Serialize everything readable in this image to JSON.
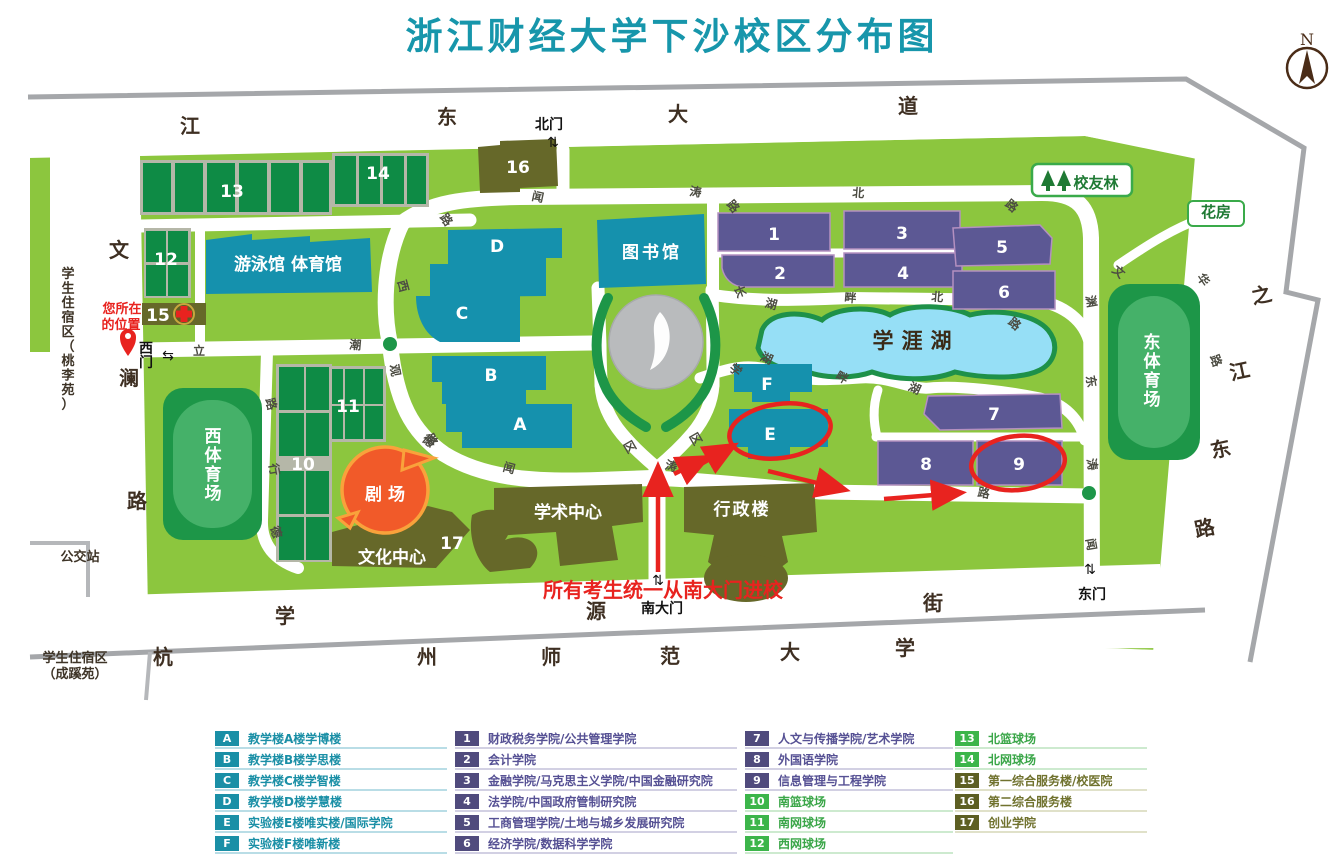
{
  "title": "浙江财经大学下沙校区分布图",
  "compass": {
    "label": "N"
  },
  "colors": {
    "title_teal": "#1796ab",
    "campus_green": "#8cc63e",
    "teal_building": "#1591ad",
    "purple_building": "#5c5894",
    "olive_building": "#666829",
    "court_green": "#0e8b45",
    "stadium_green": "#1d9648",
    "lake_blue": "#96dff6",
    "highlight_red": "#e8231f",
    "theater_orange": "#f15a29",
    "road_gray": "#a5a7aa"
  },
  "map": {
    "streets": {
      "north": "江东大道",
      "west": "文澜路",
      "south": "学源街",
      "east": "之江东路",
      "south_neighbor": "杭州师范大学"
    },
    "gates": {
      "north": "北门",
      "west": "西门",
      "south": "南大门",
      "east": "东门"
    },
    "annotations": {
      "you_are_here_line1": "您所在",
      "you_are_here_line2": "的位置",
      "entrance_note": "所有考生统一从南大门进校"
    },
    "labels": [
      {
        "t": "江",
        "x": 190,
        "y": 133,
        "cls": "st",
        "n": "street-char-jiangdong"
      },
      {
        "t": "东",
        "x": 447,
        "y": 124,
        "cls": "st",
        "n": "street-char-jiangdong"
      },
      {
        "t": "大",
        "x": 678,
        "y": 121,
        "cls": "st",
        "n": "street-char-jiangdong"
      },
      {
        "t": "道",
        "x": 908,
        "y": 113,
        "cls": "st",
        "n": "street-char-jiangdong"
      },
      {
        "t": "文",
        "x": 119,
        "y": 257,
        "cls": "st",
        "n": "street-char-wenlan"
      },
      {
        "t": "澜",
        "x": 129,
        "y": 385,
        "cls": "st",
        "n": "street-char-wenlan"
      },
      {
        "t": "路",
        "x": 137,
        "y": 508,
        "cls": "st",
        "n": "street-char-wenlan"
      },
      {
        "t": "学",
        "x": 285,
        "y": 623,
        "cls": "st",
        "n": "street-char-xueyuan"
      },
      {
        "t": "源",
        "x": 596,
        "y": 618,
        "cls": "st",
        "n": "street-char-xueyuan"
      },
      {
        "t": "街",
        "x": 933,
        "y": 610,
        "cls": "st",
        "n": "street-char-xueyuan"
      },
      {
        "t": "之",
        "x": 1263,
        "y": 302,
        "cls": "st",
        "r": -12,
        "n": "street-char-zhijiangdong"
      },
      {
        "t": "江",
        "x": 1241,
        "y": 378,
        "cls": "st",
        "r": -12,
        "n": "street-char-zhijiangdong"
      },
      {
        "t": "东",
        "x": 1222,
        "y": 456,
        "cls": "st",
        "r": -12,
        "n": "street-char-zhijiangdong"
      },
      {
        "t": "路",
        "x": 1206,
        "y": 535,
        "cls": "st",
        "r": -12,
        "n": "street-char-zhijiangdong"
      },
      {
        "t": "杭",
        "x": 163,
        "y": 664,
        "cls": "st",
        "n": "street-char-hangshida"
      },
      {
        "t": "州",
        "x": 427,
        "y": 664,
        "cls": "st",
        "n": "street-char-hangshida"
      },
      {
        "t": "师",
        "x": 551,
        "y": 664,
        "cls": "st",
        "n": "street-char-hangshida"
      },
      {
        "t": "范",
        "x": 670,
        "y": 663,
        "cls": "st",
        "n": "street-char-hangshida"
      },
      {
        "t": "大",
        "x": 790,
        "y": 659,
        "cls": "st",
        "n": "street-char-hangshida"
      },
      {
        "t": "学",
        "x": 905,
        "y": 655,
        "cls": "st",
        "n": "street-char-hangshida"
      },
      {
        "t": "闻",
        "x": 537,
        "y": 201,
        "cls": "rd",
        "r": 12
      },
      {
        "t": "涛",
        "x": 695,
        "y": 196,
        "cls": "rd",
        "r": 8
      },
      {
        "t": "北",
        "x": 858,
        "y": 197,
        "cls": "rd",
        "r": 5
      },
      {
        "t": "路",
        "x": 1009,
        "y": 209,
        "cls": "rd",
        "r": 40
      },
      {
        "t": "路",
        "x": 730,
        "y": 209,
        "cls": "rd",
        "r": 50
      },
      {
        "t": "路",
        "x": 443,
        "y": 222,
        "cls": "rd",
        "r": 55
      },
      {
        "t": "西",
        "x": 399,
        "y": 287,
        "cls": "rd",
        "r": 75
      },
      {
        "t": "潮",
        "x": 355,
        "y": 349,
        "cls": "rd",
        "r": 5
      },
      {
        "t": "立",
        "x": 199,
        "y": 355,
        "cls": "rd"
      },
      {
        "t": "观",
        "x": 391,
        "y": 371,
        "cls": "rd",
        "r": 80
      },
      {
        "t": "路",
        "x": 428,
        "y": 442,
        "cls": "rd",
        "r": 60
      },
      {
        "t": "路",
        "x": 267,
        "y": 405,
        "cls": "rd",
        "r": 75
      },
      {
        "t": "行",
        "x": 270,
        "y": 470,
        "cls": "rd",
        "r": 80
      },
      {
        "t": "德",
        "x": 272,
        "y": 533,
        "cls": "rd",
        "r": 75
      },
      {
        "t": "德",
        "x": 426,
        "y": 444,
        "cls": "rd",
        "r": 40
      },
      {
        "t": "闻",
        "x": 508,
        "y": 472,
        "cls": "rd",
        "r": 15
      },
      {
        "t": "涛",
        "x": 670,
        "y": 470,
        "cls": "rd",
        "r": 15
      },
      {
        "t": "长",
        "x": 736,
        "y": 293,
        "cls": "rd",
        "r": 70
      },
      {
        "t": "湖",
        "x": 770,
        "y": 308,
        "cls": "rd",
        "r": 15
      },
      {
        "t": "畔",
        "x": 850,
        "y": 302,
        "cls": "rd",
        "r": 5
      },
      {
        "t": "北",
        "x": 937,
        "y": 301,
        "cls": "rd",
        "r": 5
      },
      {
        "t": "路",
        "x": 1012,
        "y": 327,
        "cls": "rd",
        "r": 40
      },
      {
        "t": "学",
        "x": 733,
        "y": 373,
        "cls": "rd",
        "r": 40
      },
      {
        "t": "湖",
        "x": 765,
        "y": 362,
        "cls": "rd",
        "r": 25
      },
      {
        "t": "畔",
        "x": 840,
        "y": 381,
        "cls": "rd",
        "r": 30
      },
      {
        "t": "区",
        "x": 626,
        "y": 449,
        "cls": "rd",
        "r": 60
      },
      {
        "t": "区",
        "x": 692,
        "y": 441,
        "cls": "rd",
        "r": 60
      },
      {
        "t": "湖",
        "x": 913,
        "y": 392,
        "cls": "rd",
        "r": 25
      },
      {
        "t": "路",
        "x": 983,
        "y": 497,
        "cls": "rd",
        "r": 10
      },
      {
        "t": "文",
        "x": 1116,
        "y": 275,
        "cls": "rd",
        "r": 40
      },
      {
        "t": "渊",
        "x": 1087,
        "y": 302,
        "cls": "rd",
        "r": 80
      },
      {
        "t": "东",
        "x": 1087,
        "y": 382,
        "cls": "rd",
        "r": 80
      },
      {
        "t": "涛",
        "x": 1088,
        "y": 465,
        "cls": "rd",
        "r": 80
      },
      {
        "t": "闻",
        "x": 1087,
        "y": 545,
        "cls": "rd",
        "r": 80
      },
      {
        "t": "华",
        "x": 1200,
        "y": 282,
        "cls": "rd",
        "r": 55
      },
      {
        "t": "路",
        "x": 1212,
        "y": 362,
        "cls": "rd",
        "r": 70
      },
      {
        "t": "A",
        "x": 520,
        "y": 430,
        "cls": "un",
        "n": "unit-label-a"
      },
      {
        "t": "B",
        "x": 491,
        "y": 381,
        "cls": "un",
        "n": "unit-label-b"
      },
      {
        "t": "C",
        "x": 462,
        "y": 319,
        "cls": "un",
        "n": "unit-label-c"
      },
      {
        "t": "D",
        "x": 497,
        "y": 252,
        "cls": "un",
        "n": "unit-label-d"
      },
      {
        "t": "E",
        "x": 770,
        "y": 440,
        "cls": "un",
        "n": "unit-label-e"
      },
      {
        "t": "F",
        "x": 767,
        "y": 390,
        "cls": "un",
        "n": "unit-label-f"
      },
      {
        "t": "1",
        "x": 774,
        "y": 240,
        "cls": "un",
        "n": "unit-label-1"
      },
      {
        "t": "2",
        "x": 780,
        "y": 279,
        "cls": "un",
        "n": "unit-label-2"
      },
      {
        "t": "3",
        "x": 902,
        "y": 239,
        "cls": "un",
        "n": "unit-label-3"
      },
      {
        "t": "4",
        "x": 903,
        "y": 279,
        "cls": "un",
        "n": "unit-label-4"
      },
      {
        "t": "5",
        "x": 1002,
        "y": 253,
        "cls": "un",
        "n": "unit-label-5"
      },
      {
        "t": "6",
        "x": 1004,
        "y": 298,
        "cls": "un",
        "n": "unit-label-6"
      },
      {
        "t": "7",
        "x": 994,
        "y": 420,
        "cls": "un",
        "n": "unit-label-7"
      },
      {
        "t": "8",
        "x": 926,
        "y": 470,
        "cls": "un",
        "n": "unit-label-8"
      },
      {
        "t": "9",
        "x": 1019,
        "y": 470,
        "cls": "un",
        "n": "unit-label-9"
      },
      {
        "t": "10",
        "x": 303,
        "y": 470,
        "cls": "un",
        "s": 15,
        "n": "unit-label-10"
      },
      {
        "t": "11",
        "x": 348,
        "y": 412,
        "cls": "un",
        "s": 15,
        "n": "unit-label-11"
      },
      {
        "t": "12",
        "x": 166,
        "y": 265,
        "cls": "un",
        "s": 15,
        "n": "unit-label-12"
      },
      {
        "t": "13",
        "x": 232,
        "y": 197,
        "cls": "un",
        "n": "unit-label-13"
      },
      {
        "t": "14",
        "x": 378,
        "y": 179,
        "cls": "un",
        "s": 15,
        "n": "unit-label-14"
      },
      {
        "t": "15",
        "x": 158,
        "y": 321,
        "cls": "un",
        "s": 15,
        "n": "unit-label-15"
      },
      {
        "t": "16",
        "x": 518,
        "y": 173,
        "cls": "un",
        "n": "unit-label-16"
      },
      {
        "t": "17",
        "x": 452,
        "y": 549,
        "cls": "un",
        "s": 14,
        "n": "unit-label-17"
      },
      {
        "t": "游泳馆  体育馆",
        "x": 288,
        "y": 270,
        "cls": "pw",
        "n": "natatorium-gym-label"
      },
      {
        "t": "图书馆",
        "x": 652,
        "y": 258,
        "cls": "pw",
        "s": 18,
        "ls": 3,
        "n": "library-label"
      },
      {
        "t": "剧 场",
        "x": 385,
        "y": 500,
        "cls": "pw",
        "s": 19,
        "n": "theater-label"
      },
      {
        "t": "文化中心",
        "x": 392,
        "y": 563,
        "cls": "pw",
        "n": "cultural-center-label"
      },
      {
        "t": "学术中心",
        "x": 568,
        "y": 518,
        "cls": "pw",
        "n": "academic-center-label"
      },
      {
        "t": "行政楼",
        "x": 742,
        "y": 515,
        "cls": "pw",
        "ls": 2,
        "n": "admin-building-label"
      },
      {
        "t": "西体育场",
        "x": 213,
        "y": 442,
        "cls": "pw",
        "v": 19,
        "n": "west-stadium-label"
      },
      {
        "t": "东体育场",
        "x": 1152,
        "y": 348,
        "cls": "pw",
        "v": 19,
        "n": "east-stadium-label"
      },
      {
        "t": "学涯湖",
        "x": 916,
        "y": 348,
        "cls": "lake",
        "ls": 8,
        "n": "lake-label"
      },
      {
        "t": "校友林",
        "x": 1096,
        "y": 188,
        "cls": "bdg",
        "n": "alumni-forest-label"
      },
      {
        "t": "花房",
        "x": 1216,
        "y": 217,
        "cls": "bdg",
        "s": 14,
        "n": "greenhouse-label"
      },
      {
        "t": "学生住宿区（桃李苑）",
        "x": 68,
        "y": 278,
        "cls": "dm",
        "v": 14.5,
        "n": "dorm-west-label"
      },
      {
        "t": "学生住宿区",
        "x": 75,
        "y": 662,
        "cls": "dm",
        "n": "dorm-south-label"
      },
      {
        "t": "（成蹊苑）",
        "x": 75,
        "y": 678,
        "cls": "dm",
        "n": "dorm-south-label"
      },
      {
        "t": "公交站",
        "x": 80,
        "y": 561,
        "cls": "dm",
        "s": 15,
        "n": "bus-stop-label"
      },
      {
        "t": "北门",
        "x": 549,
        "y": 129,
        "cls": "gt",
        "n": "north-gate-label"
      },
      {
        "t": "⇅",
        "x": 553,
        "y": 147,
        "cls": "gi",
        "n": "gate-arrow-icon"
      },
      {
        "t": "西",
        "x": 146,
        "y": 353,
        "cls": "gt",
        "n": "west-gate-label"
      },
      {
        "t": "门",
        "x": 146,
        "y": 367,
        "cls": "gt",
        "n": "west-gate-label"
      },
      {
        "t": "⇆",
        "x": 168,
        "y": 360,
        "cls": "gi",
        "n": "gate-arrow-icon"
      },
      {
        "t": "南大门",
        "x": 662,
        "y": 613,
        "cls": "gt",
        "s": 15,
        "n": "south-gate-label"
      },
      {
        "t": "⇅",
        "x": 658,
        "y": 585,
        "cls": "gi",
        "n": "gate-arrow-icon"
      },
      {
        "t": "东门",
        "x": 1092,
        "y": 599,
        "cls": "gt",
        "s": 15,
        "n": "east-gate-label"
      },
      {
        "t": "⇅",
        "x": 1090,
        "y": 574,
        "cls": "gi",
        "n": "gate-arrow-icon"
      },
      {
        "t": "您所在",
        "x": 122,
        "y": 313,
        "cls": "rs",
        "n": "you-are-here-label"
      },
      {
        "t": "的位置",
        "x": 121,
        "y": 329,
        "cls": "rs",
        "n": "you-are-here-label"
      },
      {
        "t": "所有考生统一从南大门进校",
        "x": 663,
        "y": 597,
        "cls": "rl",
        "n": "entrance-note"
      },
      {
        "t": "N",
        "x": 1307,
        "y": 45,
        "cls": "cmp",
        "n": "compass-n-label"
      }
    ]
  },
  "legend": {
    "themes": {
      "teal": {
        "badge": "#1a8fa6",
        "text": "#1a8fa6",
        "line": "#b9dde6"
      },
      "purple": {
        "badge": "#504b7d",
        "text": "#565194",
        "line": "#d2d0e3"
      },
      "green": {
        "badge": "#3cb54a",
        "text": "#3aa648",
        "line": "#cdeacf"
      },
      "olive": {
        "badge": "#5d5f23",
        "text": "#70722e",
        "line": "#e0e1c9"
      }
    },
    "columns": [
      {
        "items": [
          {
            "key": "A",
            "label": "教学楼A楼学博楼",
            "theme": "teal"
          },
          {
            "key": "B",
            "label": "教学楼B楼学思楼",
            "theme": "teal"
          },
          {
            "key": "C",
            "label": "教学楼C楼学智楼",
            "theme": "teal"
          },
          {
            "key": "D",
            "label": "教学楼D楼学慧楼",
            "theme": "teal"
          },
          {
            "key": "E",
            "label": "实验楼E楼唯实楼/国际学院",
            "theme": "teal"
          },
          {
            "key": "F",
            "label": "实验楼F楼唯新楼",
            "theme": "teal"
          }
        ]
      },
      {
        "items": [
          {
            "key": "1",
            "label": "财政税务学院/公共管理学院",
            "theme": "purple"
          },
          {
            "key": "2",
            "label": "会计学院",
            "theme": "purple"
          },
          {
            "key": "3",
            "label": "金融学院/马克思主义学院/中国金融研究院",
            "theme": "purple"
          },
          {
            "key": "4",
            "label": "法学院/中国政府管制研究院",
            "theme": "purple"
          },
          {
            "key": "5",
            "label": "工商管理学院/土地与城乡发展研究院",
            "theme": "purple"
          },
          {
            "key": "6",
            "label": "经济学院/数据科学学院",
            "theme": "purple"
          }
        ]
      },
      {
        "items": [
          {
            "key": "7",
            "label": "人文与传播学院/艺术学院",
            "theme": "purple"
          },
          {
            "key": "8",
            "label": "外国语学院",
            "theme": "purple"
          },
          {
            "key": "9",
            "label": "信息管理与工程学院",
            "theme": "purple"
          },
          {
            "key": "10",
            "label": "南篮球场",
            "theme": "green"
          },
          {
            "key": "11",
            "label": "南网球场",
            "theme": "green"
          },
          {
            "key": "12",
            "label": "西网球场",
            "theme": "green"
          }
        ]
      },
      {
        "items": [
          {
            "key": "13",
            "label": "北篮球场",
            "theme": "green"
          },
          {
            "key": "14",
            "label": "北网球场",
            "theme": "green"
          },
          {
            "key": "15",
            "label": "第一综合服务楼/校医院",
            "theme": "olive"
          },
          {
            "key": "16",
            "label": "第二综合服务楼",
            "theme": "olive"
          },
          {
            "key": "17",
            "label": "创业学院",
            "theme": "olive"
          }
        ]
      }
    ]
  }
}
